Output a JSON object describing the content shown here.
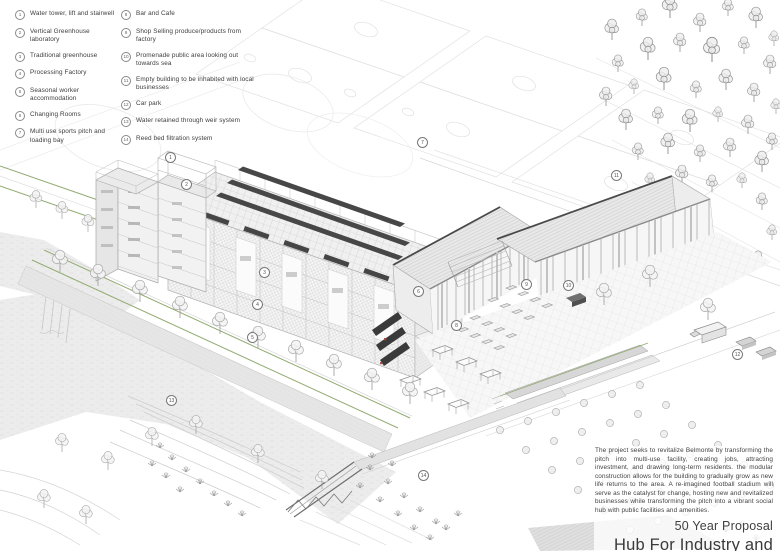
{
  "legend": {
    "columns": [
      {
        "items": [
          {
            "num": "1",
            "label": "Water tower, lift and stairwell"
          },
          {
            "num": "2",
            "label": "Vertical Greenhouse laboratory"
          },
          {
            "num": "3",
            "label": "Traditional greenhouse"
          },
          {
            "num": "4",
            "label": "Processing Factory"
          },
          {
            "num": "5",
            "label": "Seasonal worker accommodation"
          },
          {
            "num": "6",
            "label": "Changing Rooms"
          },
          {
            "num": "7",
            "label": "Multi use sports pitch and loading bay"
          }
        ]
      },
      {
        "items": [
          {
            "num": "8",
            "label": "Bar and Cafe"
          },
          {
            "num": "9",
            "label": "Shop Selling produce/products from factory"
          },
          {
            "num": "10",
            "label": "Promenade public area looking out towards sea"
          },
          {
            "num": "11",
            "label": "Empty building to be inhabited with local businesses"
          },
          {
            "num": "12",
            "label": "Car park"
          },
          {
            "num": "13",
            "label": "Water retained through weir system"
          },
          {
            "num": "14",
            "label": "Reed bed filtration system"
          }
        ]
      }
    ]
  },
  "markers": [
    {
      "num": "1",
      "x": 170,
      "y": 157
    },
    {
      "num": "2",
      "x": 186,
      "y": 184
    },
    {
      "num": "3",
      "x": 264,
      "y": 272
    },
    {
      "num": "4",
      "x": 257,
      "y": 304
    },
    {
      "num": "5",
      "x": 252,
      "y": 337
    },
    {
      "num": "6",
      "x": 418,
      "y": 291
    },
    {
      "num": "7",
      "x": 422,
      "y": 142
    },
    {
      "num": "8",
      "x": 456,
      "y": 325
    },
    {
      "num": "9",
      "x": 526,
      "y": 284
    },
    {
      "num": "10",
      "x": 568,
      "y": 285
    },
    {
      "num": "11",
      "x": 616,
      "y": 175
    },
    {
      "num": "12",
      "x": 737,
      "y": 354
    },
    {
      "num": "13",
      "x": 171,
      "y": 400
    },
    {
      "num": "14",
      "x": 423,
      "y": 475
    }
  ],
  "title_block": {
    "description": "The project seeks to revitalize Belmonte by transforming the pitch into multi-use facility, creating jobs, attracting investment, and drawing long-term residents. the modular construction allows for the building to gradually grow as new life returns to the area. A re-imagined football stadium will serve as the catalyst for change, hosting new and revitalized businesses while transforming the pitch into a vibrant social hub with public facilities and amenities.",
    "subtitle": "50 Year Proposal",
    "title": "Hub For Industry and Community"
  },
  "colors": {
    "accent_green": "#93ab72",
    "accent_red": "#b0493a",
    "dark_roof": "#474747",
    "line_light": "#e0e0e0",
    "water_fill": "#ececec"
  }
}
